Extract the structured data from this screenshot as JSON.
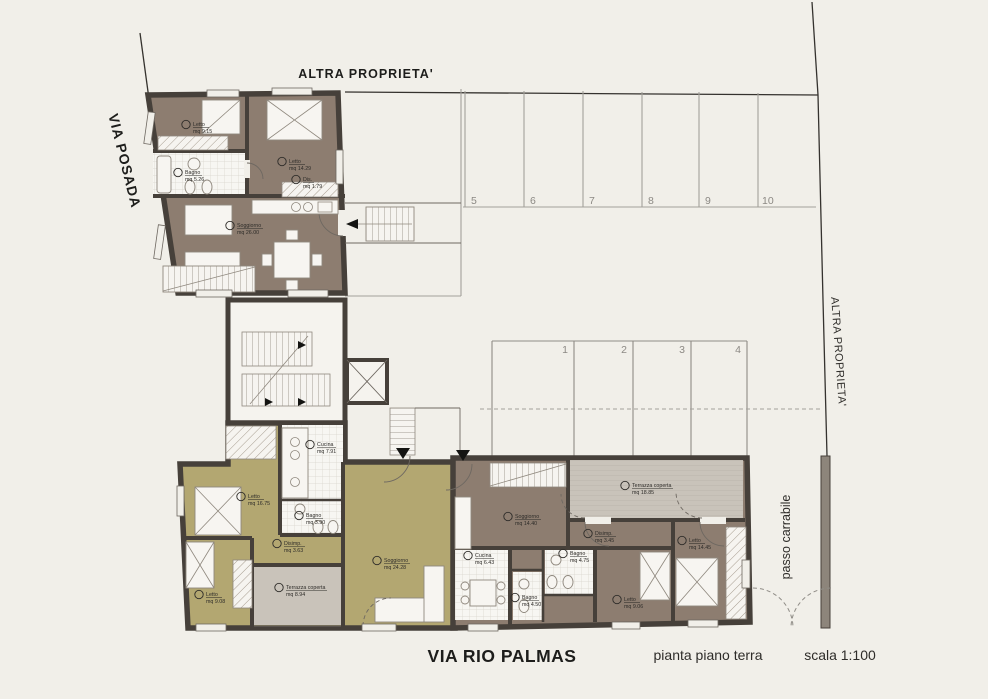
{
  "page": {
    "street_left": "VIA POSADA",
    "street_bottom": "VIA RIO PALMAS",
    "drawing_title": "pianta piano terra",
    "scale_label": "scala 1:100",
    "boundary_top": "ALTRA PROPRIETA'",
    "boundary_right": "ALTRA PROPRIETA'",
    "driveway_label": "passo carrabile"
  },
  "colors": {
    "wall": "#46403a",
    "floor_brown": "#8d7d70",
    "floor_olive": "#b3a771",
    "floor_terrace": "#c9c3ba",
    "background": "#f1efe9"
  },
  "parking": {
    "top_row": [
      "5",
      "6",
      "7",
      "8",
      "9",
      "10"
    ],
    "middle_row": [
      "1",
      "2",
      "3",
      "4"
    ]
  },
  "apartments": {
    "upper": {
      "rooms": [
        {
          "name": "Letto",
          "area": "mq 9.15"
        },
        {
          "name": "Letto",
          "area": "mq 14.29"
        },
        {
          "name": "Bagno",
          "area": "mq 5.26"
        },
        {
          "name": "Dis.",
          "area": "mq 1.79"
        },
        {
          "name": "Soggiorno",
          "area": "mq 26.00"
        }
      ]
    },
    "lower_left": {
      "rooms": [
        {
          "name": "Cucina",
          "area": "mq 7.91"
        },
        {
          "name": "Letto",
          "area": "mq 16.75"
        },
        {
          "name": "Bagno",
          "area": "mq 3.90"
        },
        {
          "name": "Disimp.",
          "area": "mq 3.63"
        },
        {
          "name": "Letto",
          "area": "mq 9.08"
        },
        {
          "name": "Terrazza coperta",
          "area": "mq 8.94"
        },
        {
          "name": "Soggiorno",
          "area": "mq 24.28"
        }
      ]
    },
    "lower_right": {
      "rooms": [
        {
          "name": "Terrazza coperta",
          "area": "mq 18.85"
        },
        {
          "name": "Soggiorno",
          "area": "mq 14.40"
        },
        {
          "name": "Disimp.",
          "area": "mq 3.45"
        },
        {
          "name": "Cucina",
          "area": "mq 6.43"
        },
        {
          "name": "Bagno",
          "area": "mq 4.75"
        },
        {
          "name": "Bagno",
          "area": "mq 4.50"
        },
        {
          "name": "Letto",
          "area": "mq 9.06"
        },
        {
          "name": "Letto",
          "area": "mq 14.45"
        }
      ]
    }
  }
}
